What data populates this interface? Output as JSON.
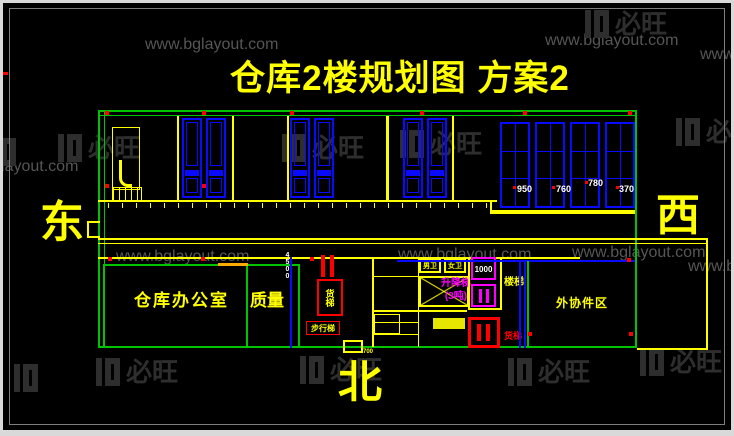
{
  "title": "仓库2楼规划图 方案2",
  "compass": {
    "east": "东",
    "west": "西",
    "north": "北"
  },
  "watermark": {
    "url": "www.bglayout.com",
    "brand": "必旺"
  },
  "rooms": {
    "office": "仓库办公室",
    "quality": "质量",
    "outsourced_parts": "外协件区",
    "lift_line1": "升降梯",
    "lift_line2": "(3吨)",
    "lift_shaft_dim": "1000",
    "toilet_left": "男卫",
    "toilet_right": "女卫",
    "stairs": "楼梯",
    "freight_lift": "货梯",
    "walk_stairs": "步行梯",
    "freight_label": "货梯"
  },
  "dims": {
    "window_widths": [
      "950",
      "760",
      "780",
      "370"
    ],
    "wall_dim": "4500",
    "door_dim": "700"
  },
  "colors": {
    "wall_green": "#00c400",
    "line_yellow": "#ffff00",
    "window_blue": "#0a0aff",
    "marker_red": "#ff0000",
    "elevator_magenta": "#ff00ff",
    "watermark_gray": "#565656",
    "background": "#000000"
  }
}
